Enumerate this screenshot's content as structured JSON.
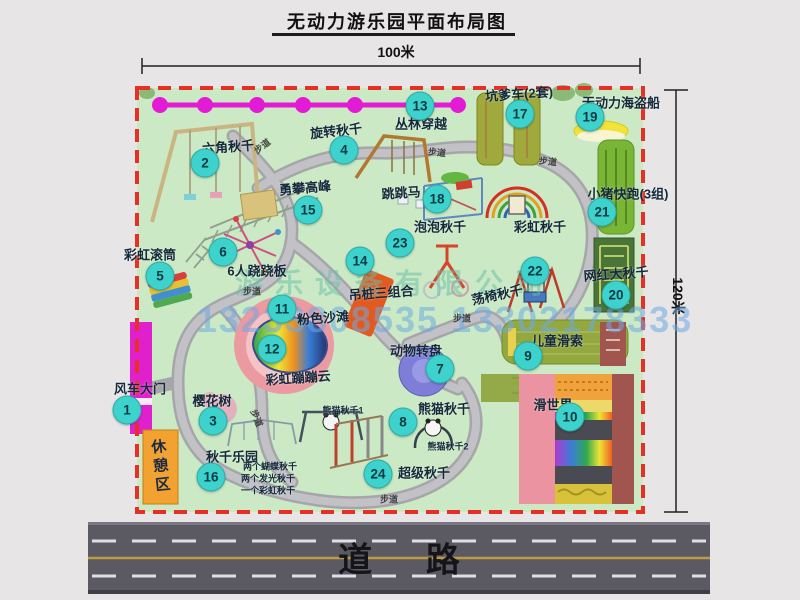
{
  "title": "无动力游乐园平面布局图",
  "dimensions": {
    "width_label": "100米",
    "height_label": "120米"
  },
  "road": {
    "label": "道 路"
  },
  "trail": {
    "label": "步道"
  },
  "watermark": {
    "company": "游乐设备有限公司",
    "phones": "13233808535 13302178333"
  },
  "rest_area": {
    "label": "休憩区"
  },
  "palette": {
    "map_green": "#cbe9c4",
    "border_red": "#e63026",
    "badge_teal": "#3ed2cc",
    "magenta": "#e41bd4",
    "rest_orange": "#f2a231",
    "road_gray": "#5b5a62"
  },
  "features": [
    {
      "n": 1,
      "label": "风车大门",
      "bx": 127,
      "by": 410,
      "lx": 140,
      "ly": 388,
      "rot": 0
    },
    {
      "n": 2,
      "label": "六角秋千",
      "bx": 205,
      "by": 163,
      "lx": 228,
      "ly": 146,
      "rot": -4
    },
    {
      "n": 3,
      "label": "樱花树",
      "bx": 213,
      "by": 421,
      "lx": 212,
      "ly": 400,
      "rot": 0
    },
    {
      "n": 4,
      "label": "旋转秋千",
      "bx": 344,
      "by": 150,
      "lx": 336,
      "ly": 130,
      "rot": -6
    },
    {
      "n": 5,
      "label": "彩虹滚筒",
      "bx": 160,
      "by": 276,
      "lx": 150,
      "ly": 254,
      "rot": 0
    },
    {
      "n": 6,
      "label": "6人跷跷板",
      "bx": 223,
      "by": 252,
      "lx": 257,
      "ly": 270,
      "rot": 0
    },
    {
      "n": 7,
      "label": "动物转盘",
      "bx": 440,
      "by": 369,
      "lx": 416,
      "ly": 350,
      "rot": 0
    },
    {
      "n": 8,
      "label": "熊猫秋千",
      "bx": 403,
      "by": 422,
      "lx": 444,
      "ly": 408,
      "rot": 0
    },
    {
      "n": 9,
      "label": "儿童滑索",
      "bx": 528,
      "by": 356,
      "lx": 557,
      "ly": 340,
      "rot": 0
    },
    {
      "n": 10,
      "label": "滑世界",
      "bx": 570,
      "by": 417,
      "lx": 553,
      "ly": 404,
      "rot": 0
    },
    {
      "n": 11,
      "label": "粉色沙滩",
      "bx": 282,
      "by": 309,
      "lx": 323,
      "ly": 317,
      "rot": -4
    },
    {
      "n": 12,
      "label": "彩虹蹦蹦云",
      "bx": 272,
      "by": 349,
      "lx": 298,
      "ly": 377,
      "rot": -4
    },
    {
      "n": 13,
      "label": "丛林穿越",
      "bx": 420,
      "by": 106,
      "lx": 421,
      "ly": 123,
      "rot": 0
    },
    {
      "n": 14,
      "label": "吊桩三组合",
      "bx": 360,
      "by": 261,
      "lx": 381,
      "ly": 292,
      "rot": -4
    },
    {
      "n": 15,
      "label": "勇攀高峰",
      "bx": 308,
      "by": 210,
      "lx": 305,
      "ly": 187,
      "rot": -5
    },
    {
      "n": 16,
      "label": "秋千乐园",
      "bx": 211,
      "by": 477,
      "lx": 232,
      "ly": 456,
      "rot": 0
    },
    {
      "n": 17,
      "label": "坑爹车(2套)",
      "bx": 520,
      "by": 114,
      "lx": 519,
      "ly": 93,
      "rot": -4
    },
    {
      "n": 18,
      "label": "跳跳马",
      "bx": 437,
      "by": 199,
      "lx": 401,
      "ly": 192,
      "rot": -4
    },
    {
      "n": 19,
      "label": "无动力海盗船",
      "bx": 590,
      "by": 117,
      "lx": 621,
      "ly": 102,
      "rot": 0
    },
    {
      "n": 20,
      "label": "网红大秋千",
      "bx": 616,
      "by": 295,
      "lx": 616,
      "ly": 273,
      "rot": -4
    },
    {
      "n": 21,
      "label": "小猪快跑(3组)",
      "bx": 602,
      "by": 212,
      "lx": 628,
      "ly": 193,
      "rot": 0
    },
    {
      "n": 22,
      "label": "荡椅秋千",
      "bx": 535,
      "by": 271,
      "lx": 497,
      "ly": 294,
      "rot": -12
    },
    {
      "n": 23,
      "label": "泡泡秋千",
      "bx": 400,
      "by": 243,
      "lx": 440,
      "ly": 226,
      "rot": 0
    },
    {
      "n": 24,
      "label": "超级秋千",
      "bx": 378,
      "by": 474,
      "lx": 424,
      "ly": 472,
      "rot": 0
    }
  ],
  "extra_labels": [
    {
      "text": "彩虹秋千",
      "x": 540,
      "y": 226,
      "size": 13,
      "rot": 0
    },
    {
      "text": "熊猫秋千1",
      "x": 343,
      "y": 410,
      "size": 9,
      "rot": 0
    },
    {
      "text": "熊猫秋千2",
      "x": 448,
      "y": 446,
      "size": 9,
      "rot": 0
    },
    {
      "text": "两个蝴蝶秋千",
      "x": 270,
      "y": 466,
      "size": 9,
      "rot": 0
    },
    {
      "text": "两个发光秋千",
      "x": 268,
      "y": 478,
      "size": 9,
      "rot": 0
    },
    {
      "text": "一个彩虹秋千",
      "x": 268,
      "y": 490,
      "size": 9,
      "rot": 0
    }
  ],
  "trail_labels": [
    {
      "x": 262,
      "y": 146,
      "rot": -38
    },
    {
      "x": 437,
      "y": 152,
      "rot": 6
    },
    {
      "x": 548,
      "y": 161,
      "rot": 6
    },
    {
      "x": 252,
      "y": 291,
      "rot": 0
    },
    {
      "x": 462,
      "y": 318,
      "rot": 0
    },
    {
      "x": 257,
      "y": 418,
      "rot": 68
    },
    {
      "x": 389,
      "y": 499,
      "rot": 0
    }
  ]
}
